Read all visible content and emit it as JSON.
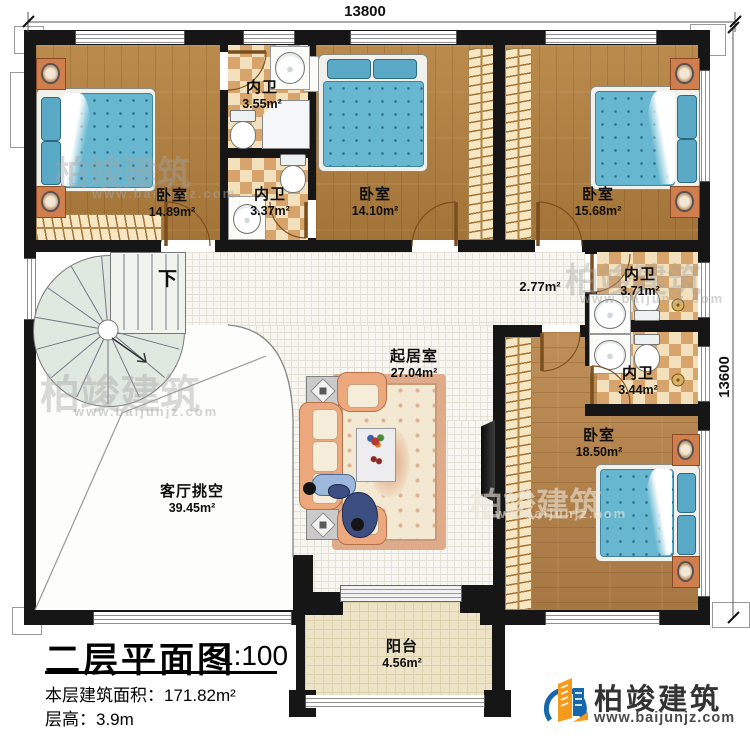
{
  "plan": {
    "dim_top": "13800",
    "dim_right": "13600",
    "stair_down": "下"
  },
  "rooms": {
    "bedroom_tl": {
      "name": "卧室",
      "area": "14.89m²"
    },
    "bath_top": {
      "name": "内卫",
      "area": "3.55m²"
    },
    "bath_mid": {
      "name": "内卫",
      "area": "3.37m²"
    },
    "bedroom_tm": {
      "name": "卧室",
      "area": "14.10m²"
    },
    "bedroom_tr": {
      "name": "卧室",
      "area": "15.68m²"
    },
    "bath_r1": {
      "name": "内卫",
      "area": "3.71m²"
    },
    "bath_r2": {
      "name": "内卫",
      "area": "3.44m²"
    },
    "bedroom_br": {
      "name": "卧室",
      "area": "18.50m²"
    },
    "living": {
      "name": "起居室",
      "area": "27.04m²"
    },
    "hall": {
      "area": "2.77m²"
    },
    "void": {
      "name": "客厅挑空",
      "area": "39.45m²"
    },
    "balcony": {
      "name": "阳台",
      "area": "4.56m²"
    }
  },
  "titleblock": {
    "title": "二层平面图",
    "scale": "1:100",
    "floor_area": "本层建筑面积：171.82m²",
    "floor_height": "层高：3.9m"
  },
  "brand": {
    "name": "柏竣建筑",
    "url": "www.baijunjz.com"
  },
  "watermark": {
    "name": "柏竣建筑",
    "url": "www.baijunjz.com"
  }
}
